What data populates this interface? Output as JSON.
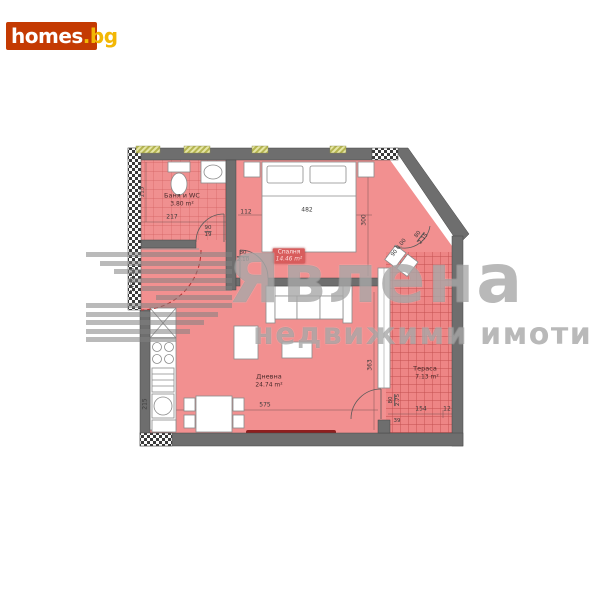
{
  "logo": {
    "main": "homes",
    "suffix": ".bg"
  },
  "watermark": {
    "brand": "Явлена",
    "tagline": "недвижими имоти"
  },
  "rooms": {
    "bath": {
      "name": "Баня и WC",
      "area": "3.80 m²"
    },
    "bedroom": {
      "name": "Спалня",
      "area": "14.46 m²"
    },
    "living": {
      "name": "Дневна",
      "area": "24.74 m²"
    },
    "terrace": {
      "name": "Тераса",
      "area": "7.13 m²"
    }
  },
  "dims": {
    "bath_width": "217",
    "bath_side": "115",
    "bath_door_w": "90",
    "bath_door_h": "19",
    "hall_offset": "112",
    "bedroom_width": "482",
    "bedroom_depth": "300",
    "bedroom_door_w": "80",
    "bedroom_door_h": "2.10",
    "diag_door": "90 0.00",
    "diag_window_w": "80",
    "diag_window_h": "2.15",
    "living_width": "575",
    "living_depth": "363",
    "kitchen_wall": "215",
    "entry_door": "140/2.20",
    "terrace_door_w": "80",
    "terrace_door_h": "2.75",
    "terrace_door_sill": "39",
    "terrace_width": "154",
    "terrace_edge": "12"
  },
  "colors": {
    "accent": "#c43a02",
    "logo_suffix": "#f2b705",
    "floor": "#f29090",
    "tile_line": "#d26060",
    "wall": "#6e6e6e",
    "watermark": "#787878",
    "highlight": "#d85c5c"
  }
}
